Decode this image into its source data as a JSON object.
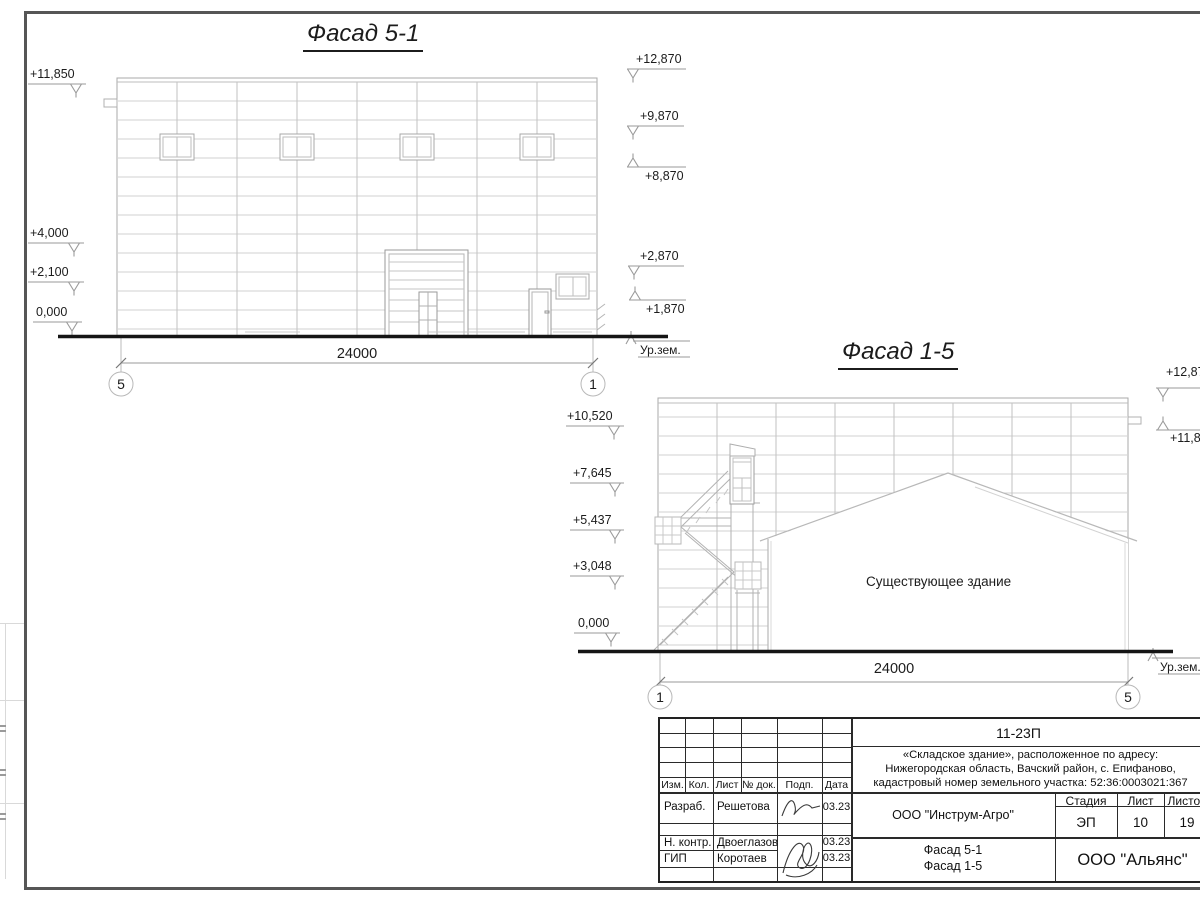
{
  "drawing": {
    "facade_5_1": {
      "title": "Фасад 5-1",
      "dimension": "24000",
      "axis_left": "5",
      "axis_right": "1",
      "ground_label": "Ур.зем.",
      "elevations_left": [
        "+11,850",
        "+4,000",
        "+2,100",
        "0,000"
      ],
      "elevations_right": [
        "+12,870",
        "+9,870",
        "+8,870",
        "+2,870",
        "+1,870"
      ]
    },
    "facade_1_5": {
      "title": "Фасад 1-5",
      "dimension": "24000",
      "axis_left": "1",
      "axis_right": "5",
      "ground_label": "Ур.зем.",
      "existing_building": "Существующее здание",
      "elevations_left": [
        "+10,520",
        "+7,645",
        "+5,437",
        "+3,048",
        "0,000"
      ],
      "elevations_right": [
        "+12,870",
        "+11,850"
      ]
    }
  },
  "title_block": {
    "code": "11-23П",
    "address_line1": "«Складское здание», расположенное по адресу:",
    "address_line2": "Нижегородская область, Вачский район, с. Епифаново,",
    "address_line3": "кадастровый номер земельного участка: 52:36:0003021:367",
    "col_izm": "Изм.",
    "col_kol": "Кол.",
    "col_list": "Лист",
    "col_doc": "№ док.",
    "col_podp": "Подп.",
    "col_data": "Дата",
    "row1_role": "Разраб.",
    "row1_name": "Решетова",
    "row1_date": "03.23",
    "row2_role": "Н. контр.",
    "row2_name": "Двоеглазов",
    "row2_date": "03.23",
    "row3_role": "ГИП",
    "row3_name": "Коротаев",
    "row3_date": "03.23",
    "organization": "ООО \"Инструм-Агро\"",
    "stage_label": "Стадия",
    "sheet_label": "Лист",
    "sheets_label": "Листов",
    "stage": "ЭП",
    "sheet": "10",
    "sheets": "19",
    "subtitle_line1": "Фасад 5-1",
    "subtitle_line2": "Фасад 1-5",
    "company": "ООО \"Альянс\""
  }
}
